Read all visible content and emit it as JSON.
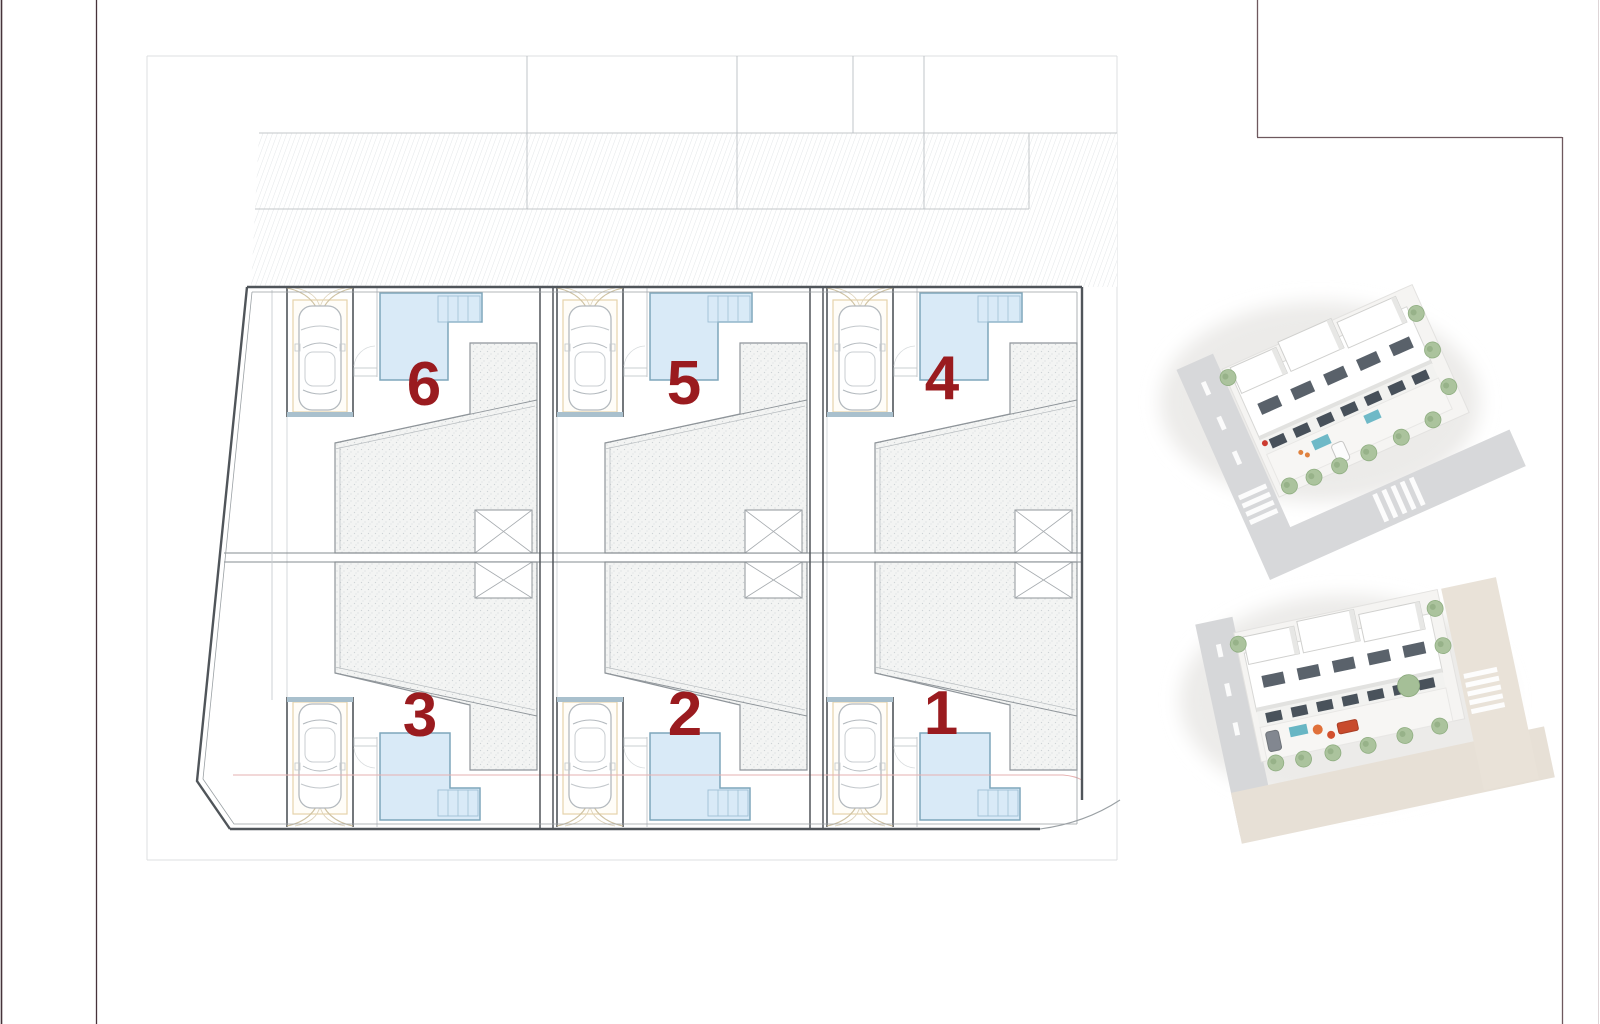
{
  "plan": {
    "units": [
      {
        "label": "6",
        "row": "top",
        "position": "left"
      },
      {
        "label": "5",
        "row": "top",
        "position": "middle"
      },
      {
        "label": "4",
        "row": "top",
        "position": "right"
      },
      {
        "label": "3",
        "row": "bottom",
        "position": "left"
      },
      {
        "label": "2",
        "row": "bottom",
        "position": "middle"
      },
      {
        "label": "1",
        "row": "bottom",
        "position": "right"
      }
    ],
    "label_color": "#9a1b1f",
    "pool_fill": "#d9eaf7",
    "pool_stroke": "#7ea6bb",
    "boundary_color": "#50555a",
    "garage_band_color": "#a9c0cd",
    "drive_arch_color": "#cfc2a2",
    "car_outline_color": "#b3b9be",
    "setback_line_color": "#e6b0b0",
    "frame_line_color": "#46333a",
    "corner_frame_color": "#6e585e"
  },
  "renders": [
    {
      "name": "aerial-render-top"
    },
    {
      "name": "aerial-render-bottom"
    }
  ]
}
